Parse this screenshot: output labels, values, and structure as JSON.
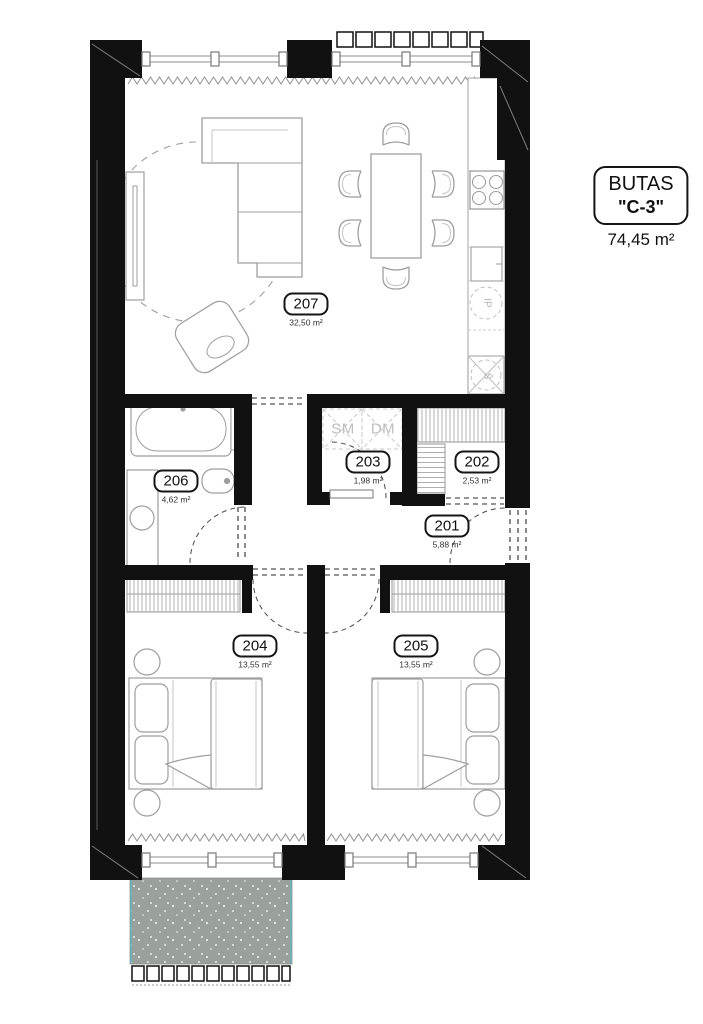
{
  "title": {
    "name": "BUTAS",
    "unit": "\"C-3\"",
    "total_area": "74,45 m²"
  },
  "rooms": [
    {
      "number": "201",
      "area": "5,88 m²"
    },
    {
      "number": "202",
      "area": "2,53 m²"
    },
    {
      "number": "203",
      "area": "1,98 m²"
    },
    {
      "number": "204",
      "area": "13,55 m²"
    },
    {
      "number": "205",
      "area": "13,55 m²"
    },
    {
      "number": "206",
      "area": "4,62 m²"
    },
    {
      "number": "207",
      "area": "32,50 m²"
    }
  ],
  "appliances": {
    "sm": "SM",
    "dm": "DM",
    "ip": "IP",
    "fridge": "Š"
  },
  "colors": {
    "wall": "#111111",
    "furniture_line": "#9e9e9e",
    "balcony_fill": "#9aa09c",
    "balcony_edge": "#5fb7c4",
    "paper": "#ffffff"
  }
}
